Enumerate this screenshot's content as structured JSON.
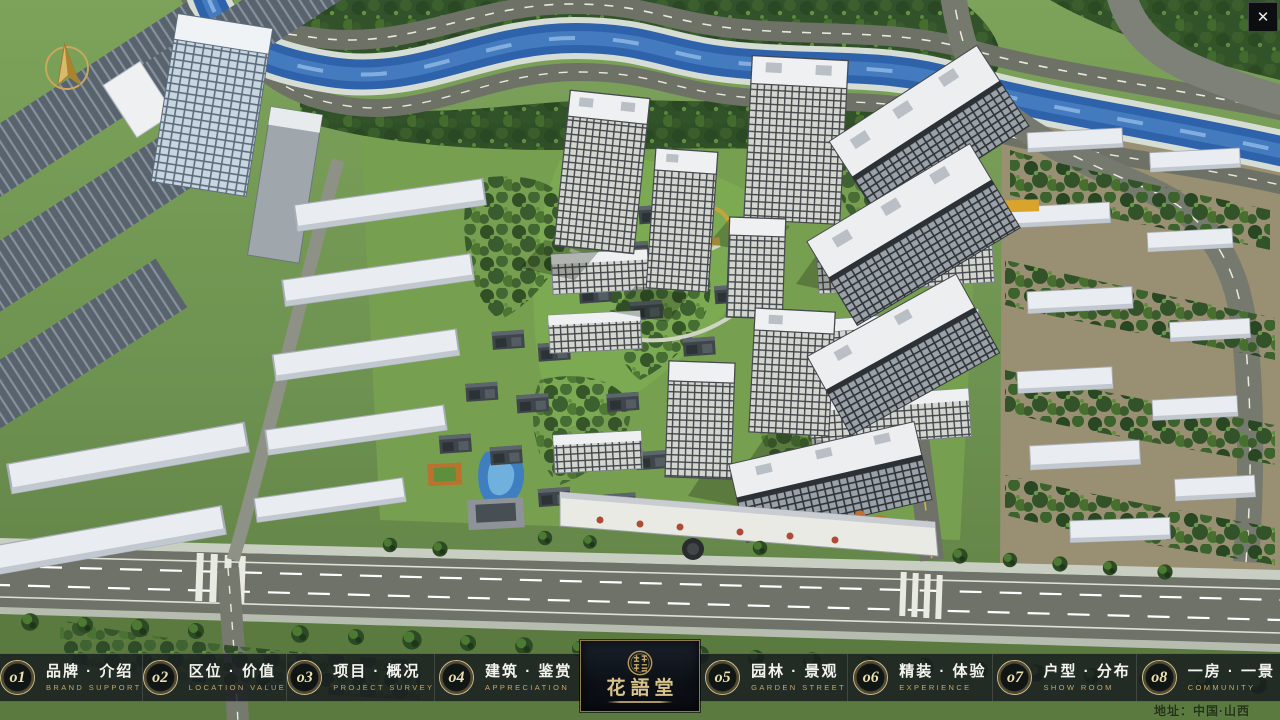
{
  "window": {
    "close_label": "✕"
  },
  "nav": {
    "items": [
      {
        "num": "o1",
        "label": "品牌 · 介绍",
        "sub": "BRAND SUPPORT"
      },
      {
        "num": "o2",
        "label": "区位 · 价值",
        "sub": "LOCATION VALUE"
      },
      {
        "num": "o3",
        "label": "项目 · 概况",
        "sub": "PROJECT SURVEY"
      },
      {
        "num": "o4",
        "label": "建筑 · 鉴赏",
        "sub": "APPRECIATION"
      },
      {
        "num": "o5",
        "label": "园林 · 景观",
        "sub": "GARDEN STREET"
      },
      {
        "num": "o6",
        "label": "精装 · 体验",
        "sub": "EXPERIENCE"
      },
      {
        "num": "o7",
        "label": "户型 · 分布",
        "sub": "SHOW ROOM"
      },
      {
        "num": "o8",
        "label": "一房 · 一景",
        "sub": "COMMUNITY"
      }
    ]
  },
  "logo": {
    "name": "花語堂"
  },
  "footer": {
    "address": "地址：中国·山西"
  },
  "colors": {
    "gold": "#cdbc8b",
    "nav_bg": "rgba(24,28,31,0.84)",
    "river": "#2e62ab",
    "grass": "#6b8c4b"
  }
}
